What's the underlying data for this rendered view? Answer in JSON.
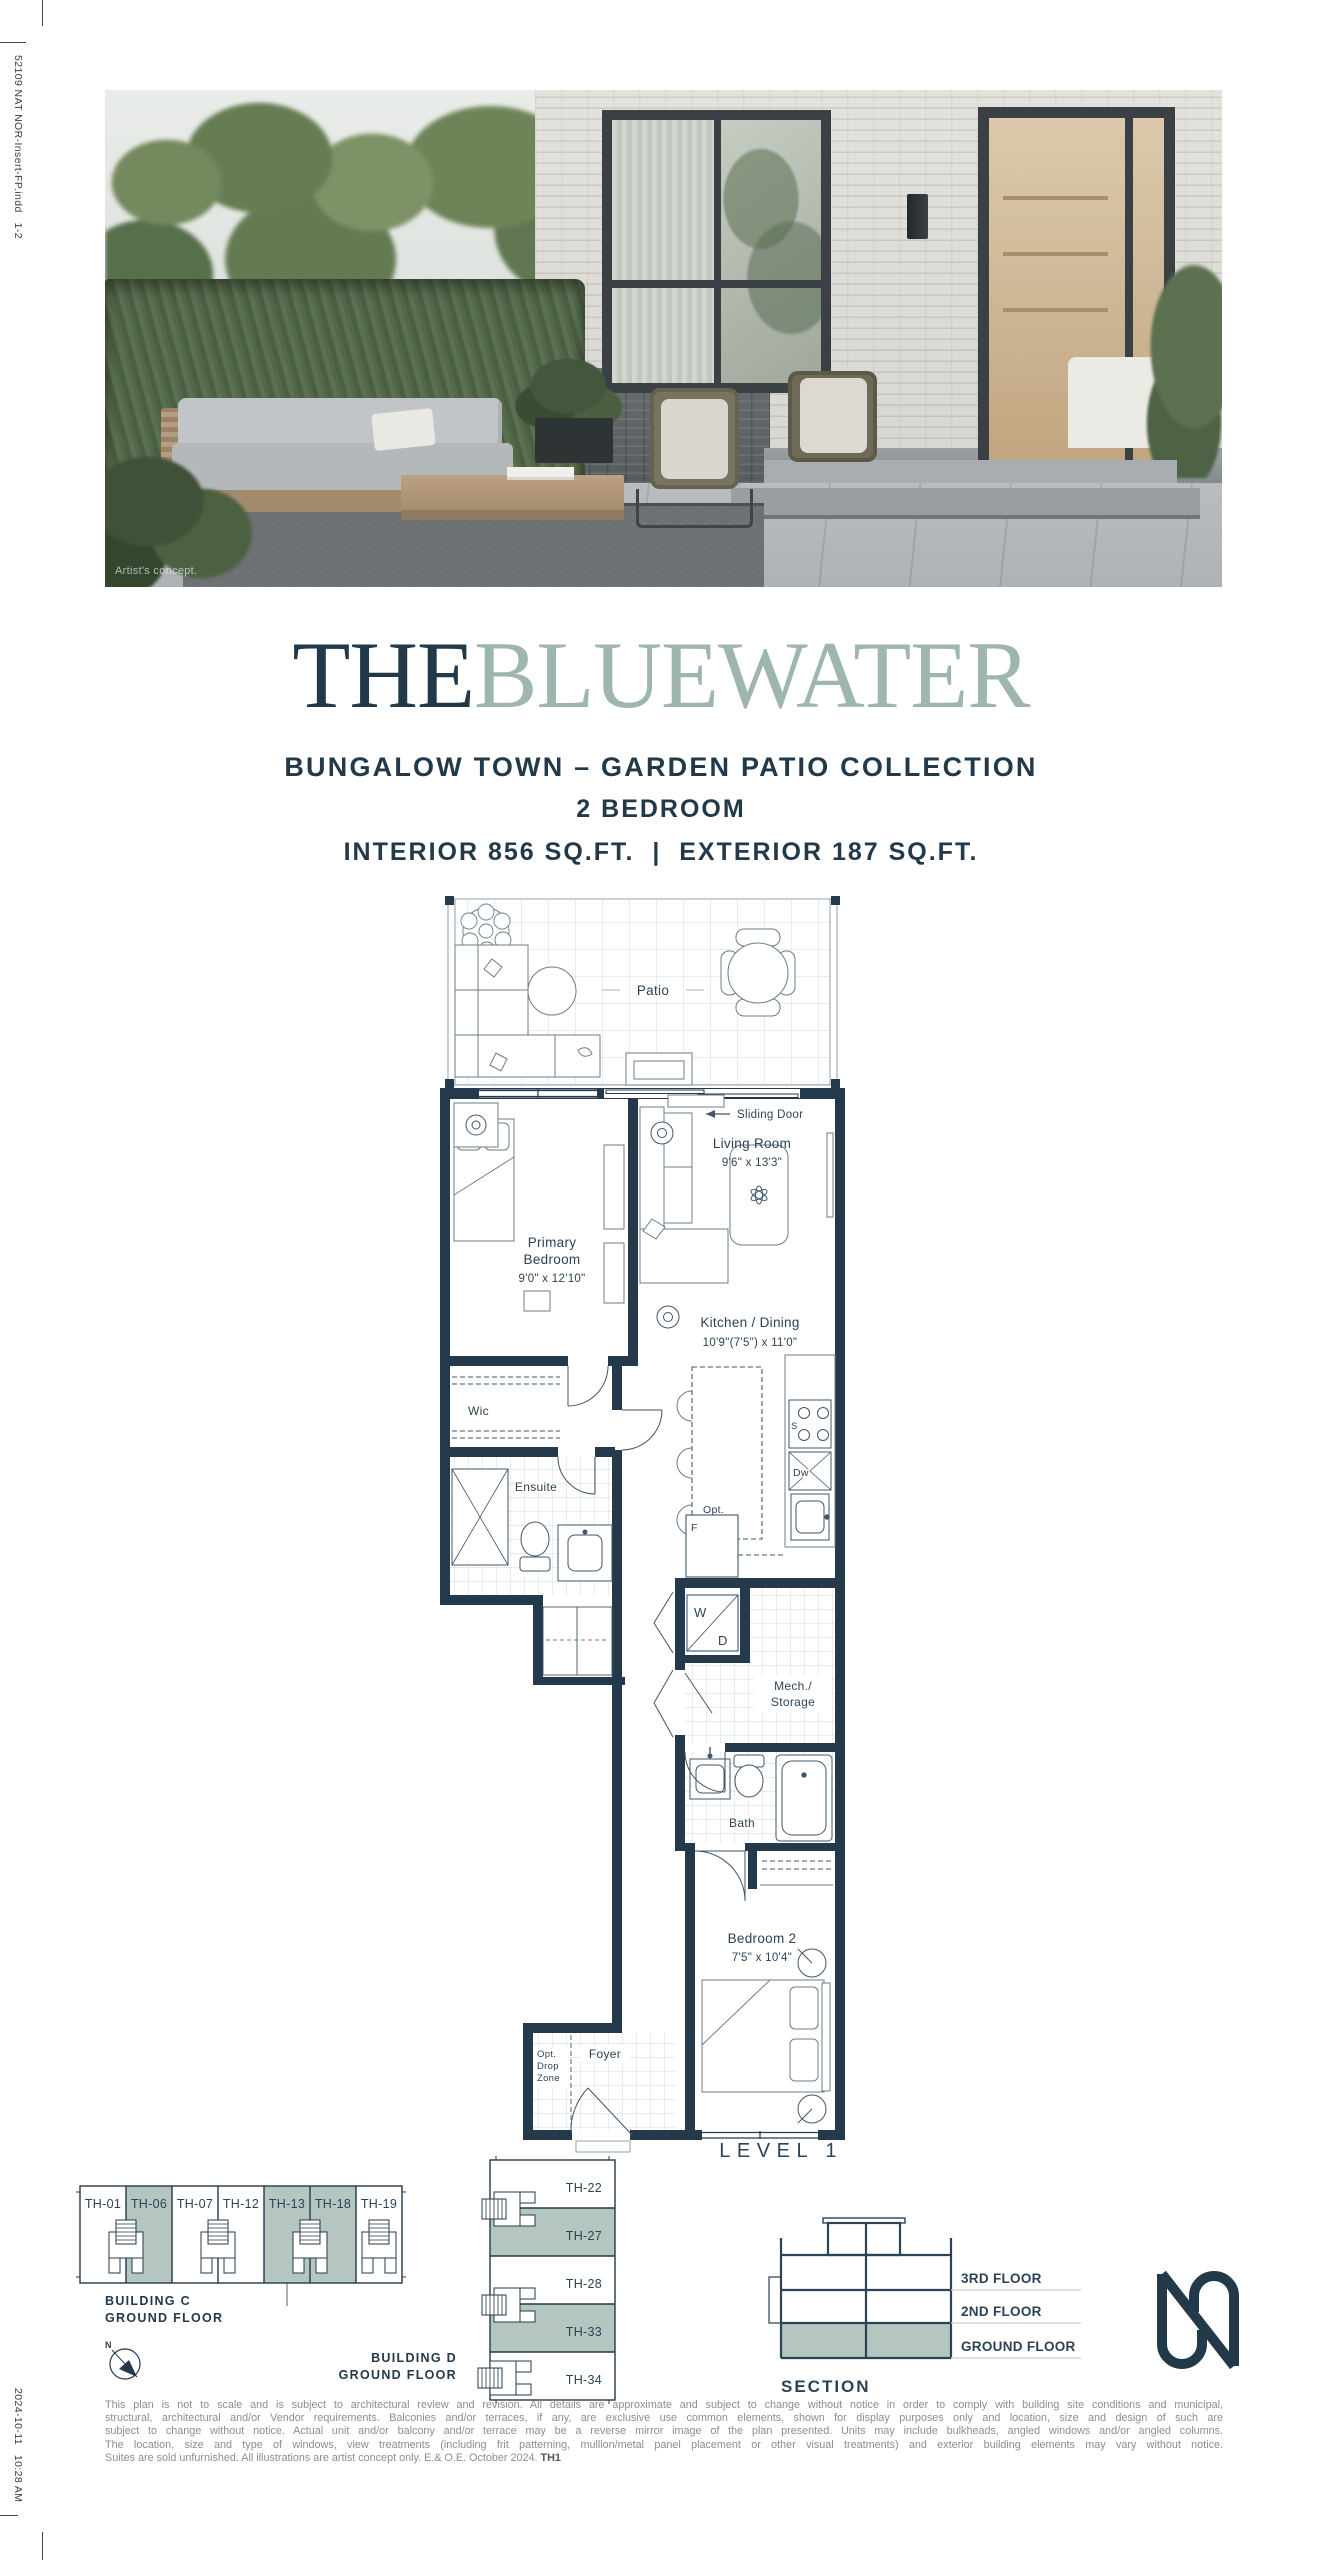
{
  "meta": {
    "slug_top": "52109 NAT NOR-Insert-FP.indd   1-2",
    "slug_bottom": "2024-10-11   10:28 AM"
  },
  "photo": {
    "caption": "Artist's concept."
  },
  "header": {
    "title_prefix": "THE",
    "title_suffix": "BLUEWATER",
    "collection": "BUNGALOW TOWN – GARDEN PATIO COLLECTION",
    "bedrooms": "2 BEDROOM",
    "area": "INTERIOR 856 SQ.FT.  |  EXTERIOR 187 SQ.FT."
  },
  "plan": {
    "level_label": "LEVEL 1",
    "rooms": {
      "patio": "Patio",
      "sliding_door": "Sliding Door",
      "living_room": {
        "name": "Living Room",
        "dims": "9'6\" x 13'3\""
      },
      "primary_bedroom": {
        "name_line1": "Primary",
        "name_line2": "Bedroom",
        "dims": "9'0\" x 12'10\""
      },
      "kitchen_dining": {
        "name": "Kitchen / Dining",
        "dims": "10'9\"(7'5\") x 11'0\""
      },
      "wic": "Wic",
      "ensuite": "Ensuite",
      "washer": "W",
      "dryer": "D",
      "fridge": "F",
      "stove": "S",
      "dishwasher": "Dw",
      "opt_island_line1": "Opt.",
      "opt_island_line2": "Island",
      "mech_line1": "Mech./",
      "mech_line2": "Storage",
      "bath": "Bath",
      "bedroom2": {
        "name": "Bedroom 2",
        "dims": "7'5\" x 10'4\""
      },
      "foyer": "Foyer",
      "drop_zone_line1": "Opt.",
      "drop_zone_line2": "Drop",
      "drop_zone_line3": "Zone"
    }
  },
  "keyplan_c": {
    "label_line1": "BUILDING C",
    "label_line2": "GROUND FLOOR",
    "units": [
      {
        "id": "TH-01",
        "fill": "#ffffff"
      },
      {
        "id": "TH-06",
        "fill": "#b5c6c0"
      },
      {
        "id": "TH-07",
        "fill": "#ffffff"
      },
      {
        "id": "TH-12",
        "fill": "#ffffff"
      },
      {
        "id": "TH-13",
        "fill": "#b5c6c0"
      },
      {
        "id": "TH-18",
        "fill": "#b5c6c0"
      },
      {
        "id": "TH-19",
        "fill": "#ffffff"
      }
    ]
  },
  "keyplan_d": {
    "label_line1": "BUILDING D",
    "label_line2": "GROUND FLOOR",
    "units": [
      {
        "id": "TH-22",
        "fill": "#ffffff"
      },
      {
        "id": "TH-27",
        "fill": "#b5c6c0"
      },
      {
        "id": "TH-28",
        "fill": "#ffffff"
      },
      {
        "id": "TH-33",
        "fill": "#b5c6c0"
      },
      {
        "id": "TH-34",
        "fill": "#ffffff"
      }
    ]
  },
  "compass": {
    "north_label": "N"
  },
  "section": {
    "label": "SECTION",
    "floors": [
      "3RD FLOOR",
      "2ND FLOOR",
      "GROUND FLOOR"
    ]
  },
  "disclaimer": {
    "lines": [
      "This plan is not to scale and is subject to architectural review and revision. All details are approximate and subject to change without notice in order to comply with building site conditions and municipal,",
      "structural, architectural and/or Vendor requirements. Balconies and/or terraces, if any, are exclusive use common elements, shown for display purposes only and location, size and design of such are",
      "subject to change without notice. Actual unit and/or balcony and/or terrace may be a reverse mirror image of the plan presented. Units may include bulkheads, angled windows and/or angled columns.",
      "The location, size and type of windows, view treatments (including frit patterning, mullion/metal panel placement or other visual treatments) and exterior building elements may vary without notice.",
      "Suites are sold unfurnished. All illustrations are artist concept only. E.& O.E. October 2024."
    ],
    "plan_code": "TH1"
  },
  "colors": {
    "navy": "#223949",
    "sage": "#b5c6c0",
    "wall": "#24394c",
    "line_gray": "#8f9ba4"
  }
}
